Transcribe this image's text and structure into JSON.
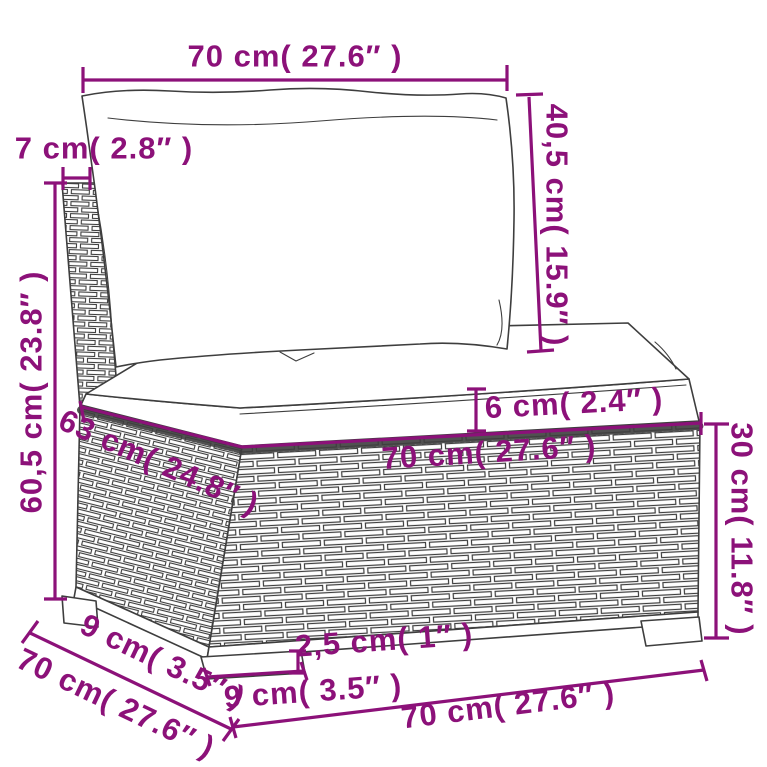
{
  "diagram": {
    "colors": {
      "accent": "#8c1179",
      "outline": "#3e3e3e"
    },
    "labels": {
      "back_width": "70 cm( 27.6″ )",
      "post_depth": "7 cm( 2.8″ )",
      "back_cushion_height": "40,5 cm( 15.9″ )",
      "overall_height": "60,5 cm( 23.8″ )",
      "seat_cushion_thickness": "6 cm( 2.4″ )",
      "seat_depth": "63 cm( 24.8″ )",
      "seat_width": "70 cm( 27.6″ )",
      "base_height": "30 cm( 11.8″ )",
      "leg_height": "2,5 cm( 1″ )",
      "front_leg_width": "9 cm( 3.5″ )",
      "side_leg_width": "9 cm( 3.5″ )",
      "side_depth": "70 cm( 27.6″ )",
      "base_width": "70 cm( 27.6″ )"
    }
  }
}
